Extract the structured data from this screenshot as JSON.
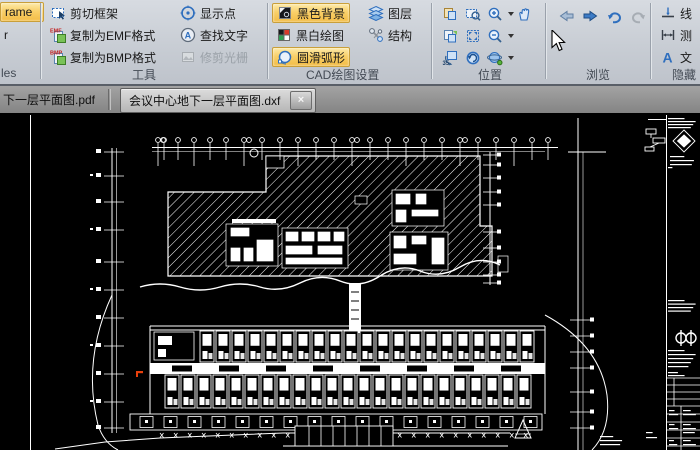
{
  "window": {
    "canvas_bg": "#000000",
    "draw_color": "#ffffff",
    "accent": "#f6c65b",
    "red_mark": "#e8400c"
  },
  "ribbon": {
    "partial_left": {
      "frame_button": "rame",
      "item_r": "r",
      "group_label": "les"
    },
    "tools": {
      "cut_frame": "剪切框架",
      "copy_emf": "复制为EMF格式",
      "copy_bmp": "复制为BMP格式",
      "show_points": "显示点",
      "find_text": "查找文字",
      "trim_raster": "修剪光栅",
      "group_label": "工具",
      "emf_badge": "EMF",
      "bmp_badge": "BMP",
      "find_badge": "A"
    },
    "cad_settings": {
      "black_background": "黑色背景",
      "bw_drawing": "黑白绘图",
      "smooth_arc": "圆滑弧形",
      "layers": "图层",
      "structure": "结构",
      "group_label": "CAD绘图设置"
    },
    "position": {
      "group_label": "位置",
      "rotate_badge": "35"
    },
    "browse": {
      "group_label": "浏览"
    },
    "partial_right": {
      "line_item": "线",
      "measure_item": "测",
      "text_item": "文",
      "text_badge": "A",
      "group_label": "隐藏"
    }
  },
  "tabs": [
    {
      "label": "下一层平面图.pdf",
      "active": false
    },
    {
      "label": "会议中心地下一层平面图.dxf",
      "active": true,
      "close": "×"
    }
  ]
}
